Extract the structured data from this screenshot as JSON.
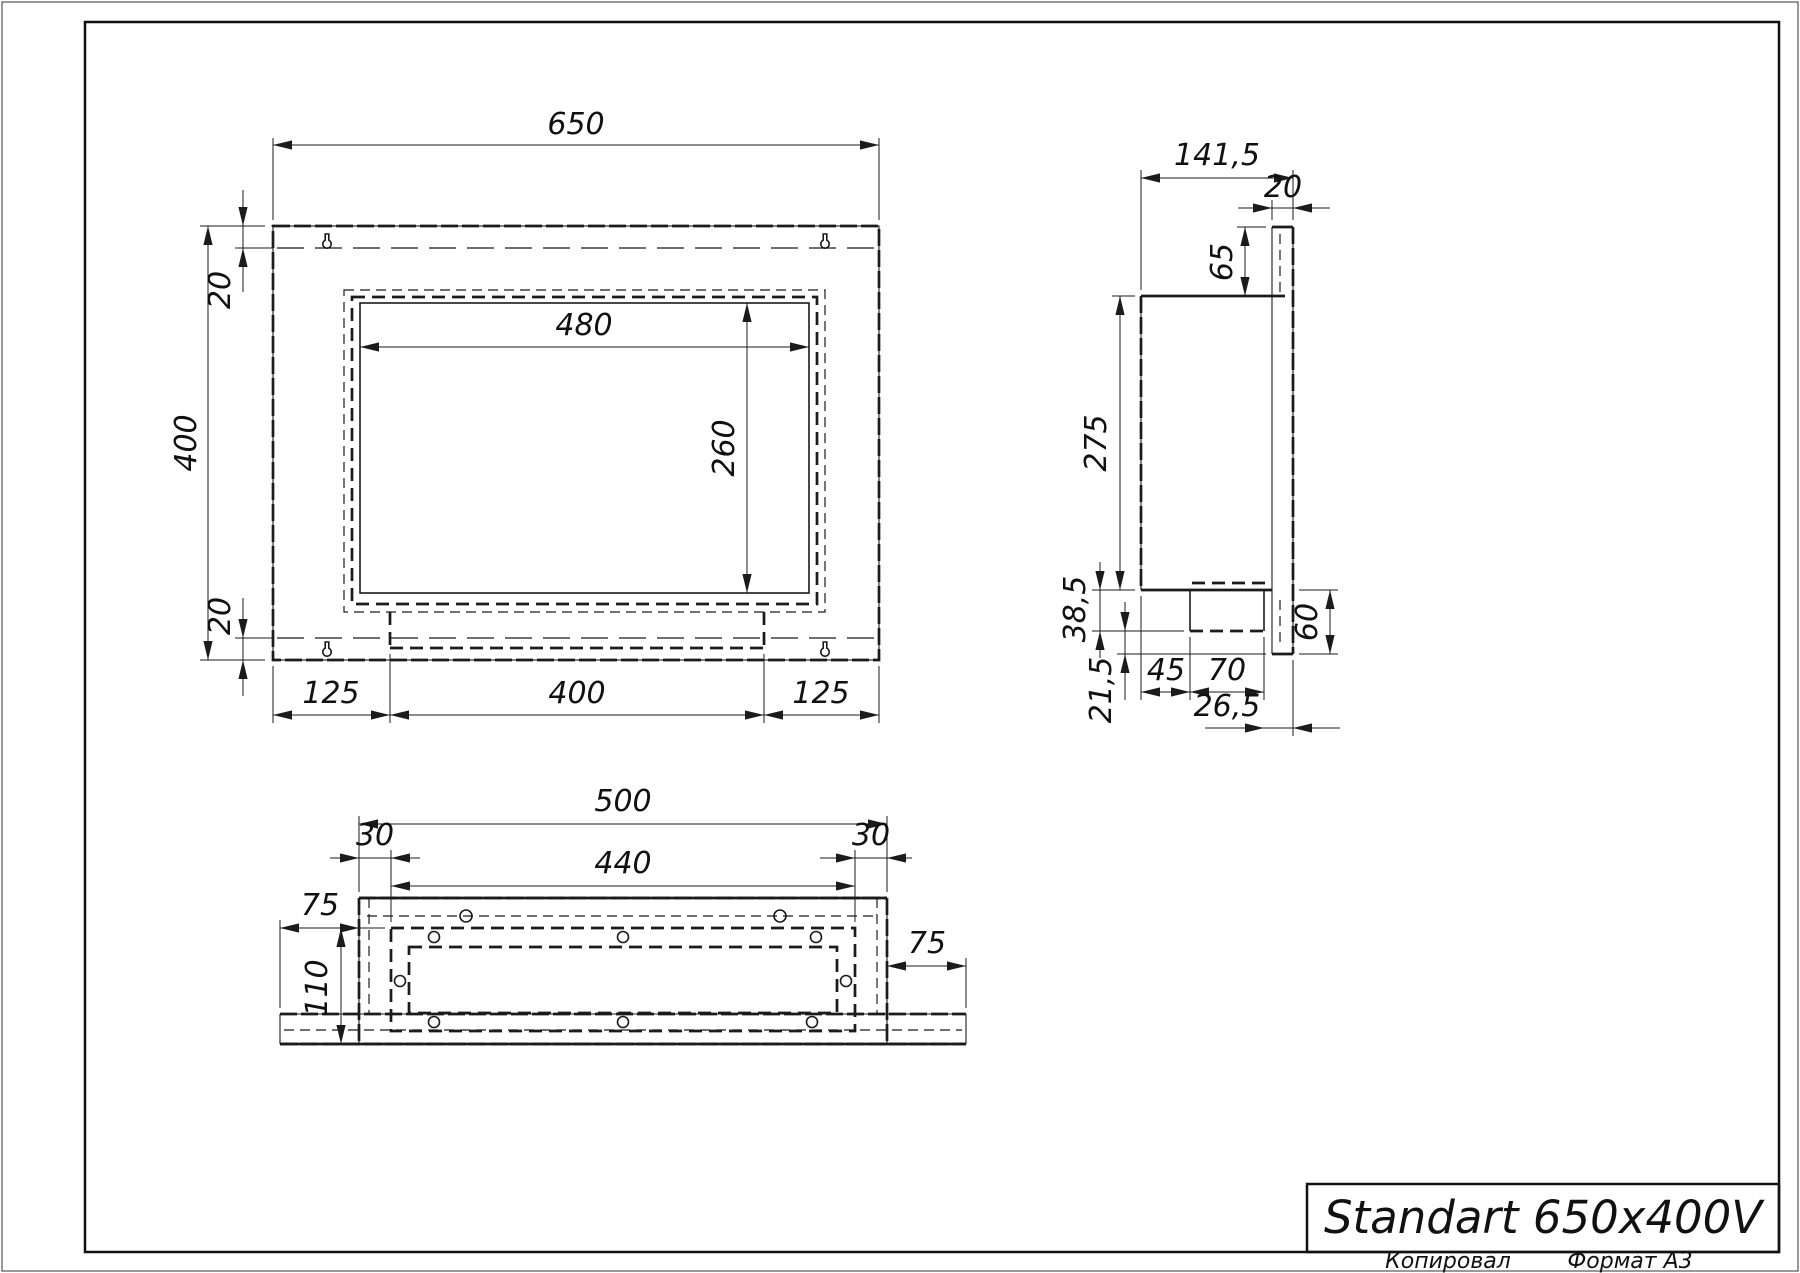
{
  "title_block": {
    "title": "Standart 650x400V",
    "copied_label": "Копировал",
    "format_label": "Формат A3"
  },
  "front_view": {
    "dims": {
      "width": "650",
      "height": "400",
      "margin_top": "20",
      "margin_bottom": "20",
      "opening_width": "480",
      "opening_height": "260",
      "mount_left": "125",
      "mount_center": "400",
      "mount_right": "125"
    }
  },
  "side_view": {
    "dims": {
      "depth": "141,5",
      "flange_thickness": "20",
      "flange_top_offset": "65",
      "body_height": "275",
      "tray_depth": "38,5",
      "flange_bottom_offset": "21,5",
      "tray_offset_left": "45",
      "tray_width": "70",
      "tray_offset_right": "26,5",
      "bottom_total": "60"
    }
  },
  "bottom_view": {
    "dims": {
      "width": "500",
      "inset_left": "30",
      "inset_right": "30",
      "inner_width": "440",
      "flange_left": "75",
      "depth": "110",
      "flange_right": "75"
    }
  }
}
